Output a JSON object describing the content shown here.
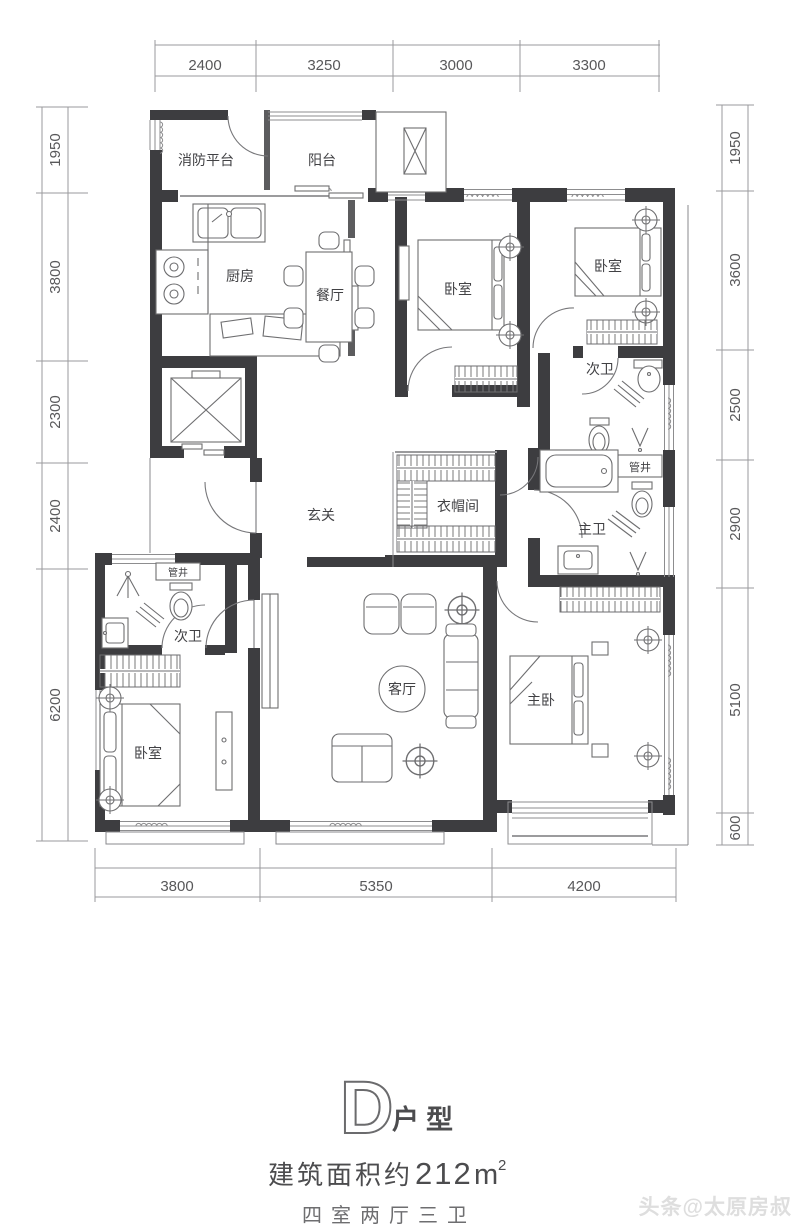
{
  "plan": {
    "rooms": [
      {
        "label": "消防平台"
      },
      {
        "label": "阳台"
      },
      {
        "label": "厨房"
      },
      {
        "label": "餐厅"
      },
      {
        "label": "卧室"
      },
      {
        "label": "卧室"
      },
      {
        "label": "次卫"
      },
      {
        "label": "管井"
      },
      {
        "label": "衣帽间"
      },
      {
        "label": "玄关"
      },
      {
        "label": "主卫"
      },
      {
        "label": "管井"
      },
      {
        "label": "次卫"
      },
      {
        "label": "卧室"
      },
      {
        "label": "客厅"
      },
      {
        "label": "主卧"
      }
    ],
    "dimensions": {
      "top": [
        "2400",
        "3250",
        "3000",
        "3300"
      ],
      "bottom": [
        "3800",
        "5350",
        "4200"
      ],
      "left": [
        "1950",
        "3800",
        "2300",
        "2400",
        "6200"
      ],
      "right": [
        "1950",
        "3600",
        "2500",
        "2900",
        "5100",
        "600"
      ]
    }
  },
  "title": {
    "plan_letter": "D",
    "plan_suffix": "户型"
  },
  "area": {
    "prefix": "建筑面积约",
    "value": "212",
    "unit": "m",
    "superscript": "2"
  },
  "subtitle": "四室两厅三卫",
  "watermark": "头条@太原房叔",
  "colors": {
    "wall": "#3d3d40",
    "lines": "#8a8a8c",
    "text": "#4a4a4c",
    "background": "#ffffff"
  }
}
